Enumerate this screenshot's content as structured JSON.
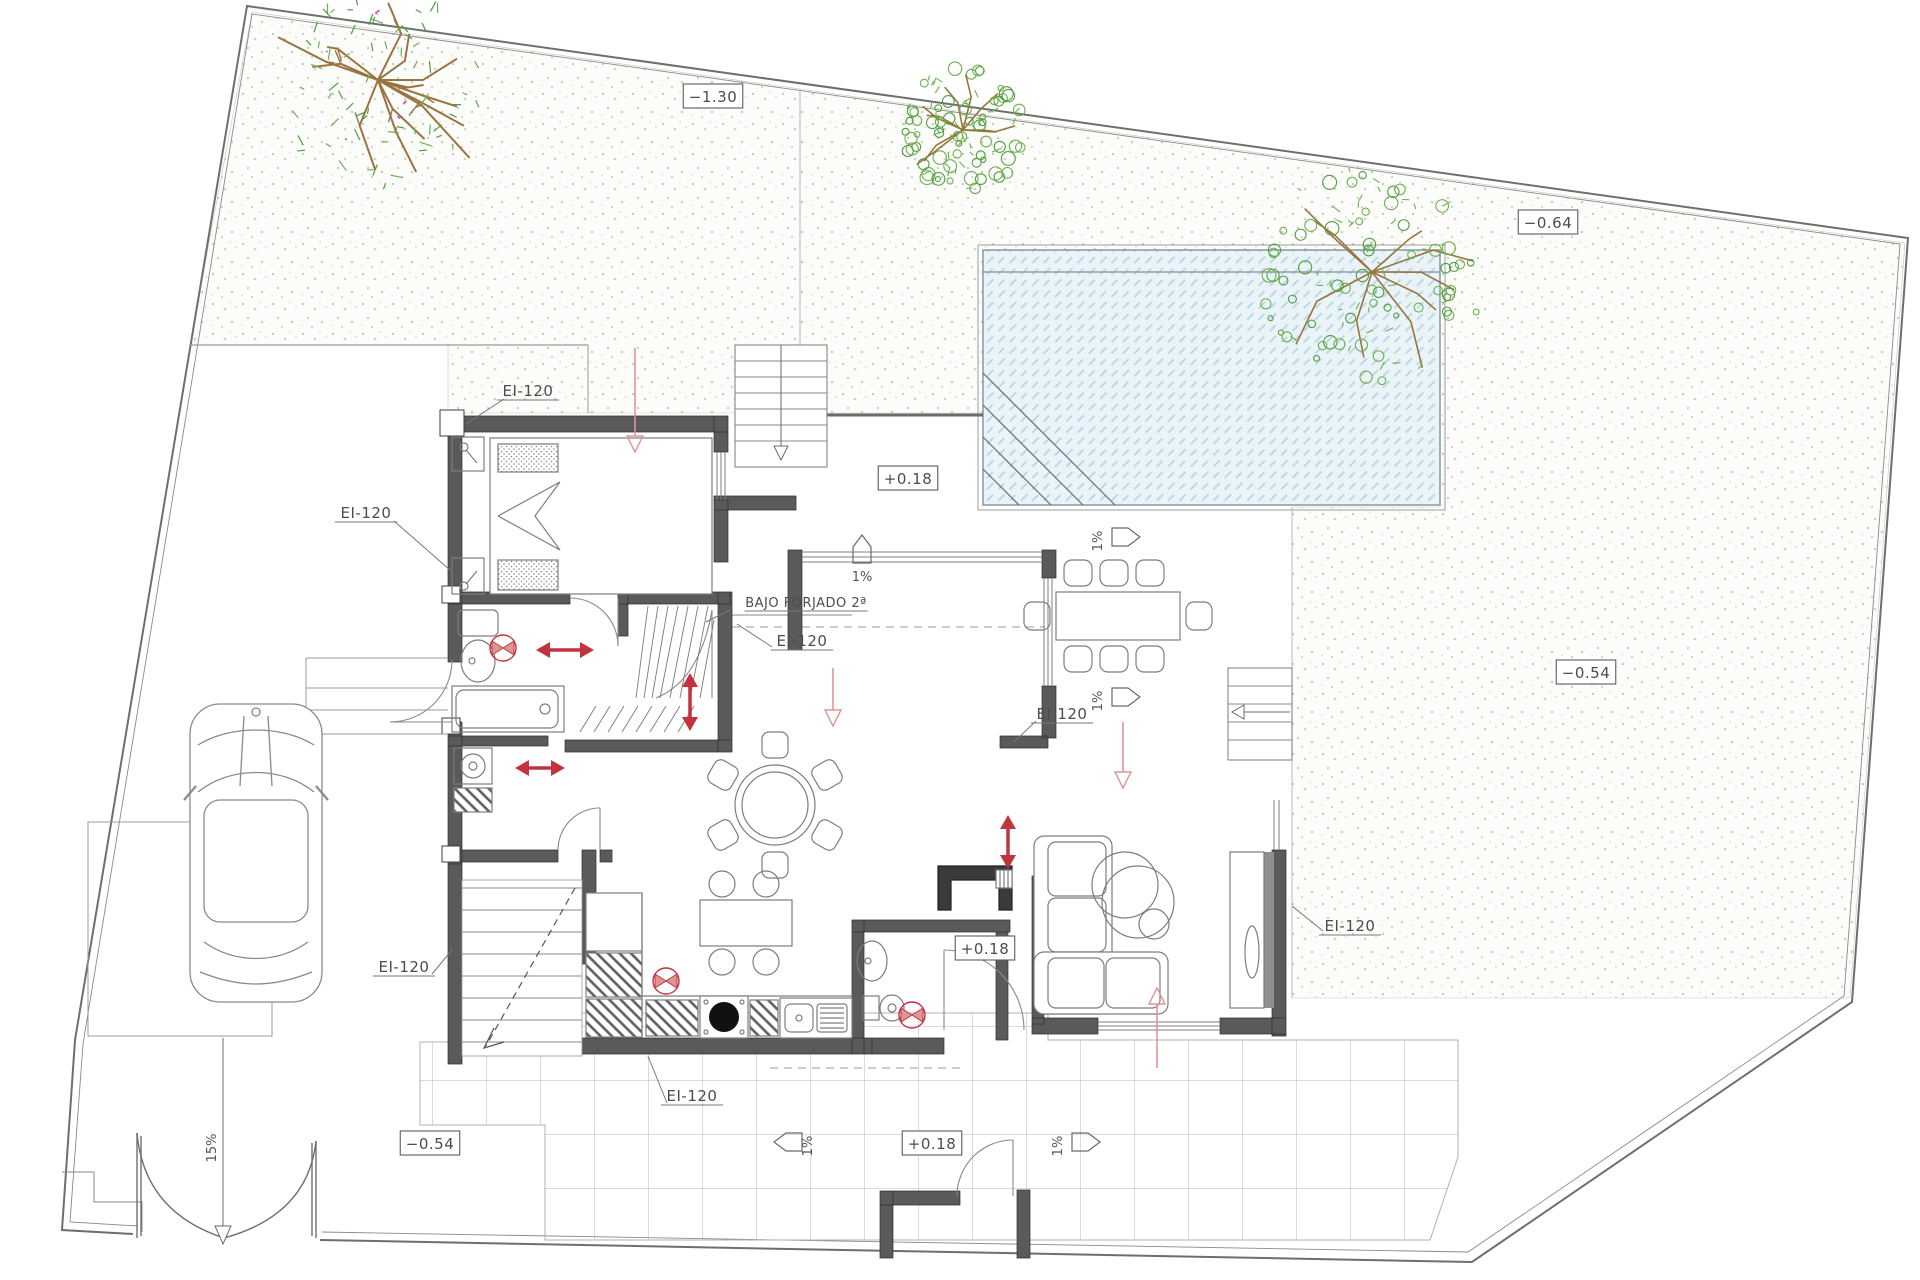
{
  "drawing": {
    "type": "architectural site / ground floor plan",
    "labels": {
      "fire_rating": "EI-120",
      "under_slab": "BAJO FORJADO 2ª"
    }
  },
  "annotations": [
    {
      "name": "level-label",
      "text": "−1.30",
      "x": 713,
      "y": 97,
      "style": "boxed"
    },
    {
      "name": "level-label",
      "text": "−0.64",
      "x": 1548,
      "y": 223,
      "style": "boxed"
    },
    {
      "name": "level-label",
      "text": "−0.54",
      "x": 1586,
      "y": 673,
      "style": "boxed"
    },
    {
      "name": "level-label",
      "text": "−0.54",
      "x": 430,
      "y": 1144,
      "style": "boxed"
    },
    {
      "name": "level-label",
      "text": "+0.18",
      "x": 908,
      "y": 479,
      "style": "boxed"
    },
    {
      "name": "level-label",
      "text": "+0.18",
      "x": 985,
      "y": 949,
      "style": "boxed"
    },
    {
      "name": "level-label",
      "text": "+0.18",
      "x": 932,
      "y": 1144,
      "style": "boxed"
    },
    {
      "name": "fire-rating-label",
      "text": "EI-120",
      "x": 528,
      "y": 391,
      "style": "underlined",
      "leader": [
        504,
        399,
        466,
        424
      ]
    },
    {
      "name": "fire-rating-label",
      "text": "EI-120",
      "x": 366,
      "y": 513,
      "style": "underlined",
      "leader": [
        394,
        521,
        450,
        570
      ]
    },
    {
      "name": "fire-rating-label",
      "text": "EI-120",
      "x": 802,
      "y": 641,
      "style": "underlined",
      "leader": [
        772,
        647,
        737,
        624
      ]
    },
    {
      "name": "fire-rating-label",
      "text": "EI-120",
      "x": 1062,
      "y": 714,
      "style": "underlined",
      "leader": [
        1036,
        721,
        1014,
        742
      ]
    },
    {
      "name": "fire-rating-label",
      "text": "EI-120",
      "x": 1350,
      "y": 926,
      "style": "underlined",
      "leader": [
        1323,
        931,
        1292,
        906
      ]
    },
    {
      "name": "fire-rating-label",
      "text": "EI-120",
      "x": 404,
      "y": 967,
      "style": "underlined",
      "leader": [
        432,
        974,
        452,
        950
      ]
    },
    {
      "name": "fire-rating-label",
      "text": "EI-120",
      "x": 692,
      "y": 1096,
      "style": "underlined",
      "leader": [
        667,
        1103,
        648,
        1056
      ]
    },
    {
      "name": "under-slab-label",
      "text": "BAJO FORJADO 2ª",
      "x": 806,
      "y": 602,
      "style": "underlined",
      "size": 13,
      "leader": [
        730,
        610,
        706,
        622
      ]
    }
  ],
  "slopes": [
    {
      "label": "1%",
      "dir": "up",
      "x": 862,
      "y": 549
    },
    {
      "label": "1%",
      "dir": "right",
      "x": 1126,
      "y": 537
    },
    {
      "label": "1%",
      "dir": "right",
      "x": 1126,
      "y": 697
    },
    {
      "label": "1%",
      "dir": "left",
      "x": 788,
      "y": 1142
    },
    {
      "label": "1%",
      "dir": "right",
      "x": 1086,
      "y": 1142
    },
    {
      "label": "15%",
      "dir": "down-long",
      "x": 223,
      "y": 1148,
      "from": 1038,
      "to": 1228
    }
  ],
  "red_marks": {
    "fans": [
      {
        "x": 503,
        "y": 648
      },
      {
        "x": 666,
        "y": 981
      },
      {
        "x": 912,
        "y": 1015
      }
    ],
    "double_arrows": [
      {
        "x": 565,
        "y": 650,
        "o": "h",
        "len": 58
      },
      {
        "x": 540,
        "y": 768,
        "o": "h",
        "len": 50
      },
      {
        "x": 690,
        "y": 702,
        "o": "v",
        "len": 58
      },
      {
        "x": 1008,
        "y": 842,
        "o": "v",
        "len": 54
      }
    ],
    "flow_arrows": [
      {
        "x1": 635,
        "y1": 348,
        "x2": 635,
        "y2": 452
      },
      {
        "x1": 833,
        "y1": 668,
        "x2": 833,
        "y2": 726
      },
      {
        "x1": 1123,
        "y1": 722,
        "x2": 1123,
        "y2": 788
      },
      {
        "x1": 1157,
        "y1": 1068,
        "x2": 1157,
        "y2": 988
      }
    ]
  },
  "site": {
    "trees": [
      {
        "x": 378,
        "y": 80,
        "r": 105,
        "style": "branchy",
        "seed": 7
      },
      {
        "x": 963,
        "y": 130,
        "r": 62,
        "style": "fluffy",
        "seed": 13
      },
      {
        "x": 1372,
        "y": 272,
        "r": 112,
        "style": "fluffy",
        "seed": 29
      }
    ]
  },
  "colors": {
    "wall": "#5a5a5a",
    "line": "#6f6f6f",
    "red": "#c2323f",
    "red_light": "#dc9795",
    "pool_water": "#e9f3f8",
    "pool_hatch": "#b7d7e3",
    "grass_dot": "#bcc8aa",
    "tree_green": "#6db04d",
    "tree_green2": "#4f9e3f",
    "tree_trunk": "#9a7440",
    "tree_accent": "#c667cc",
    "grid": "#b5b5b5"
  }
}
